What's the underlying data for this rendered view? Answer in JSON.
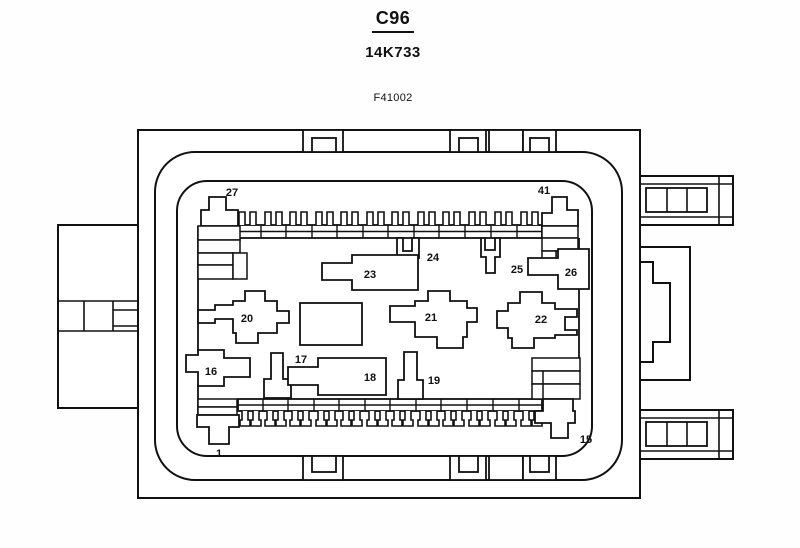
{
  "header": {
    "connector_id": "C96",
    "part_number": "14K733",
    "figure_code": "F41002"
  },
  "diagram": {
    "type": "connector-face-view",
    "line_color": "#111111",
    "fill_color": "#ffffff",
    "terminals": [
      {
        "id": "27"
      },
      {
        "id": "41"
      },
      {
        "id": "24"
      },
      {
        "id": "25"
      },
      {
        "id": "26"
      },
      {
        "id": "23"
      },
      {
        "id": "20"
      },
      {
        "id": "21"
      },
      {
        "id": "22"
      },
      {
        "id": "16"
      },
      {
        "id": "17"
      },
      {
        "id": "18"
      },
      {
        "id": "19"
      },
      {
        "id": "1"
      },
      {
        "id": "15"
      }
    ]
  }
}
